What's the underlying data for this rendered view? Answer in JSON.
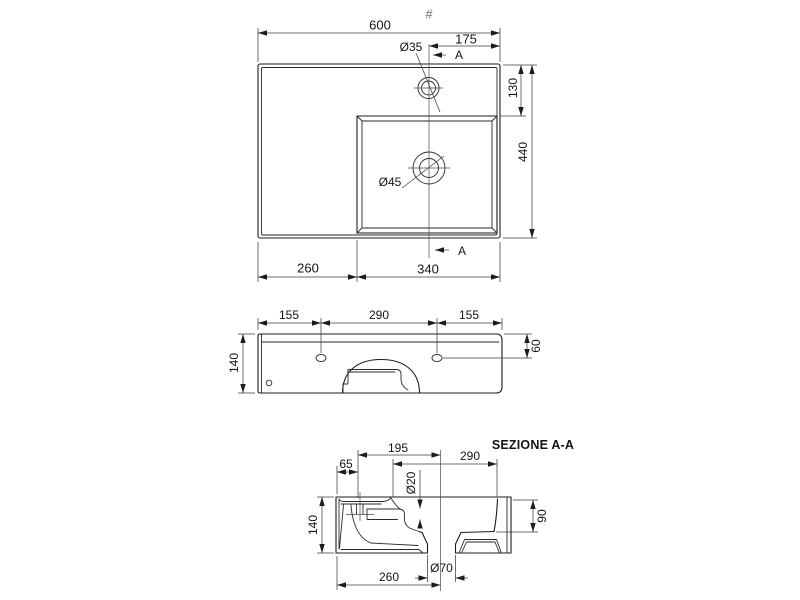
{
  "drawing": {
    "hash_mark": "#",
    "top_view": {
      "width": "600",
      "tap_offset": "175",
      "tap_hole_dia": "Ø35",
      "section_marker": "A",
      "back_depth": "130",
      "total_depth": "440",
      "bottom_left_width": "260",
      "bottom_right_width": "340",
      "drain_dia": "Ø45"
    },
    "front_view": {
      "left_span": "155",
      "center_span": "290",
      "right_span": "155",
      "height": "140",
      "hole_drop": "60"
    },
    "section_view": {
      "title": "SEZIONE A-A",
      "back_offset": "65",
      "tap_to_drain": "195",
      "bowl_width": "290",
      "overflow_dia": "Ø20",
      "height": "140",
      "bowl_depth": "90",
      "drain_offset": "260",
      "drain_dia": "Ø70"
    }
  }
}
